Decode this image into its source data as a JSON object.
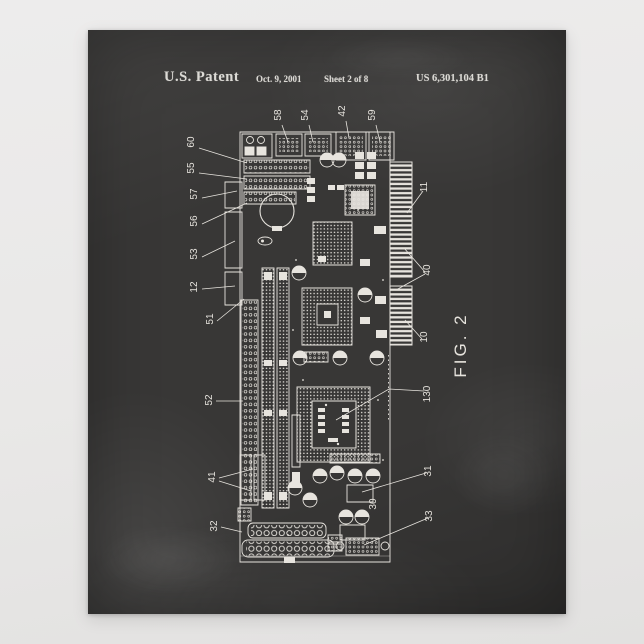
{
  "scene": {
    "background_color": "#e9e8e7",
    "poster_style": "chalkboard patent print"
  },
  "poster": {
    "board_color": "#383736",
    "chalk_color": "#e8e5df",
    "header": {
      "title": "U.S. Patent",
      "date": "Oct. 9, 2001",
      "sheet": "Sheet 2 of 8",
      "patent_number": "US 6,301,104 B1"
    },
    "figure": {
      "caption": "FIG. 2",
      "subject": "single board computer printed circuit board drawing",
      "top_labels": [
        "58",
        "54",
        "42",
        "59"
      ],
      "left_labels": [
        "60",
        "55",
        "57",
        "56",
        "53",
        "12",
        "51",
        "52",
        "41",
        "32"
      ],
      "right_labels": [
        "11",
        "40",
        "10",
        "130",
        "31",
        "33"
      ],
      "inner_labels": [
        "30"
      ]
    }
  }
}
